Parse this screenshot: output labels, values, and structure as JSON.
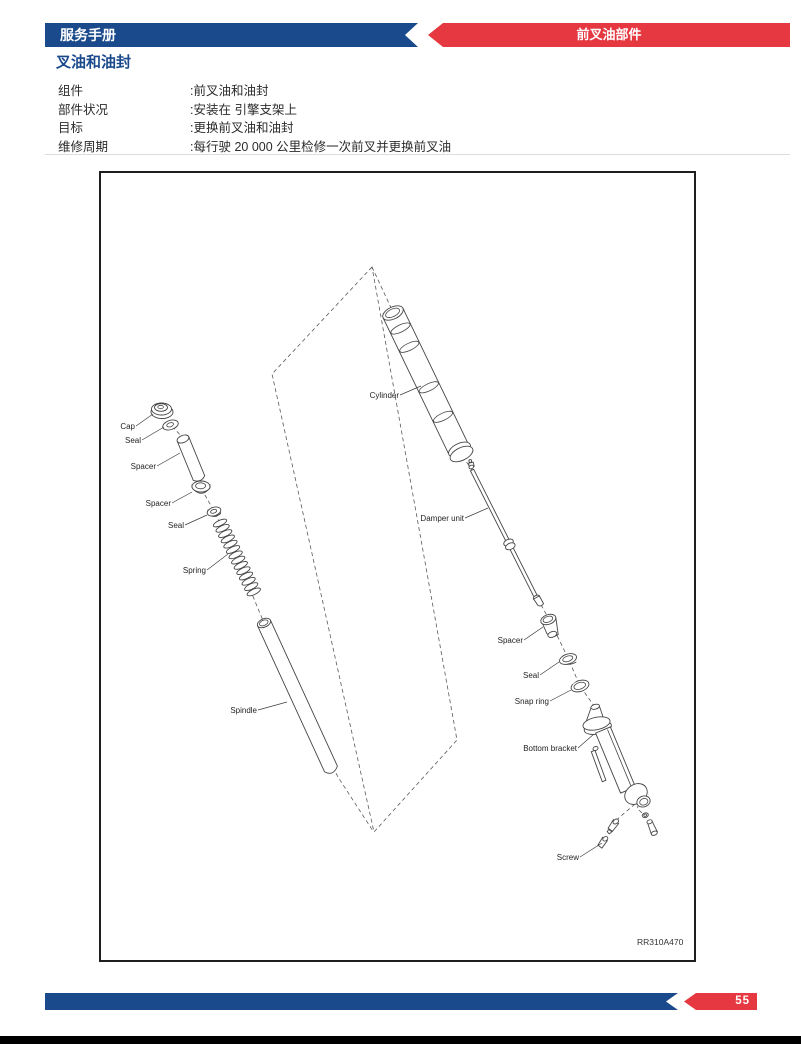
{
  "header": {
    "left_title": "服务手册",
    "right_title": "前叉油部件"
  },
  "section_title": "叉油和油封",
  "specs": [
    {
      "label": "组件",
      "value": ":前叉油和油封"
    },
    {
      "label": "部件状况",
      "value": ":安装在 引擎支架上"
    },
    {
      "label": "目标",
      "value": ":更换前叉油和油封"
    },
    {
      "label": "维修周期",
      "value": ":每行驶 20 000 公里检修一次前叉并更换前叉油"
    }
  ],
  "diagram": {
    "figure_code": "RR310A470",
    "labels": [
      {
        "text": "Cap"
      },
      {
        "text": "Seal"
      },
      {
        "text": "Spacer"
      },
      {
        "text": "Spacer"
      },
      {
        "text": "Seal"
      },
      {
        "text": "Spring"
      },
      {
        "text": "Spindle"
      },
      {
        "text": "Cylinder"
      },
      {
        "text": "Damper unit"
      },
      {
        "text": "Spacer"
      },
      {
        "text": "Seal"
      },
      {
        "text": "Snap ring"
      },
      {
        "text": "Bottom bracket"
      },
      {
        "text": "Screw"
      }
    ]
  },
  "footer": {
    "page_number": "55"
  },
  "colors": {
    "blue": "#1a4a8c",
    "red": "#e53840"
  }
}
